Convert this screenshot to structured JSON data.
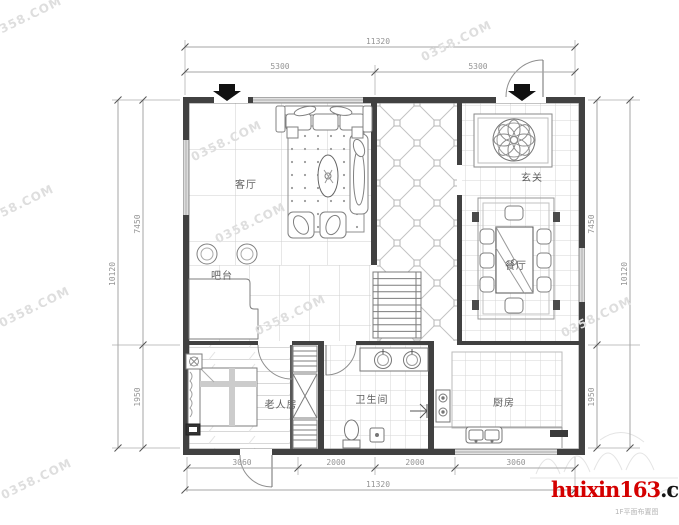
{
  "page": {
    "background": "#ffffff"
  },
  "plan": {
    "rooms": {
      "living": "客厅",
      "bar": "吧台",
      "foyer": "玄关",
      "dining": "餐厅",
      "elder": "老人房",
      "bath": "卫生间",
      "kitchen": "厨房"
    }
  },
  "dimensions": {
    "top": {
      "overall": "11320",
      "segments": [
        "5300",
        "5300"
      ]
    },
    "bottom": {
      "overall": "11320",
      "segments": [
        "3060",
        "2000",
        "2000",
        "3060"
      ]
    },
    "left": {
      "outer": "10120",
      "segments": [
        "7450",
        "1950"
      ]
    },
    "right": {
      "outer": "10120",
      "segments": [
        "7450",
        "1950"
      ]
    }
  },
  "watermark": {
    "text": "0358.COM"
  },
  "branding": {
    "site_red": "huixin163",
    "site_black": ".com",
    "caption": "1F平面布置图"
  },
  "colors": {
    "wall": "#414141",
    "accent_red": "#d40000",
    "dim_text": "#949494"
  }
}
